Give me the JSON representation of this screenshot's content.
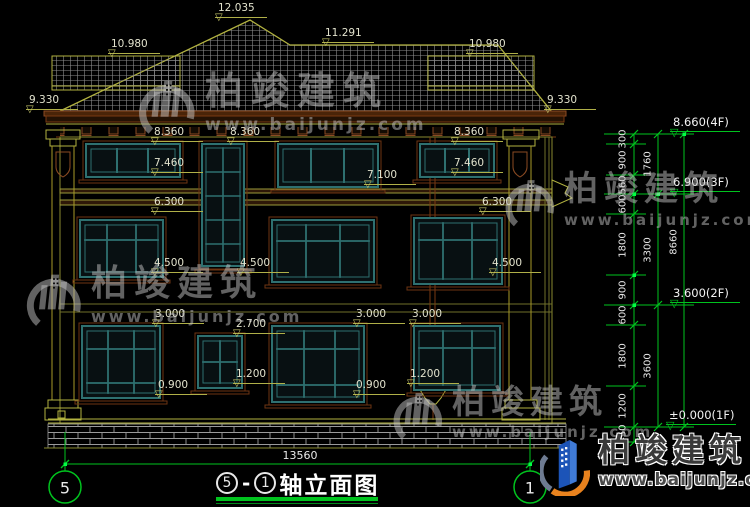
{
  "drawing_title": {
    "axis_a": "5",
    "sep": "-",
    "axis_b": "1",
    "name": "轴立面图"
  },
  "axis_bubbles": {
    "left": "5",
    "right": "1"
  },
  "overall_width": "13560",
  "watermark": {
    "brand": "柏竣建筑",
    "url": "www.baijunjz.com"
  },
  "footer_logo": {
    "brand": "柏竣建筑",
    "url": "www.baijunjz.com"
  },
  "colors": {
    "cad_green": "#00c31e",
    "cad_olive": "#b2b240",
    "window_teal": "#2e7070",
    "trim_brown": "#6e3512",
    "logo_blue": "#1c54b8",
    "logo_orange": "#e8821e"
  },
  "building_markers": [
    {
      "text": "12.035",
      "x": 215,
      "level": 20
    },
    {
      "text": "10.980",
      "x": 108,
      "level": 56
    },
    {
      "text": "11.291",
      "x": 322,
      "level": 45
    },
    {
      "text": "10.980",
      "x": 466,
      "level": 56
    },
    {
      "text": "9.330",
      "x": 26,
      "level": 112
    },
    {
      "text": "9.330",
      "x": 544,
      "level": 112
    },
    {
      "text": "8.360",
      "x": 151,
      "level": 144
    },
    {
      "text": "8.360",
      "x": 227,
      "level": 144
    },
    {
      "text": "8.360",
      "x": 451,
      "level": 144
    },
    {
      "text": "7.460",
      "x": 151,
      "level": 175
    },
    {
      "text": "7.460",
      "x": 451,
      "level": 175
    },
    {
      "text": "7.100",
      "x": 364,
      "level": 187
    },
    {
      "text": "6.300",
      "x": 151,
      "level": 214
    },
    {
      "text": "6.300",
      "x": 479,
      "level": 214
    },
    {
      "text": "4.500",
      "x": 151,
      "level": 275
    },
    {
      "text": "4.500",
      "x": 237,
      "level": 275
    },
    {
      "text": "4.500",
      "x": 489,
      "level": 275
    },
    {
      "text": "3.000",
      "x": 152,
      "level": 326
    },
    {
      "text": "3.000",
      "x": 353,
      "level": 326
    },
    {
      "text": "3.000",
      "x": 409,
      "level": 326
    },
    {
      "text": "2.700",
      "x": 233,
      "level": 336
    },
    {
      "text": "1.200",
      "x": 233,
      "level": 386
    },
    {
      "text": "1.200",
      "x": 407,
      "level": 386
    },
    {
      "text": "0.900",
      "x": 155,
      "level": 397
    },
    {
      "text": "0.900",
      "x": 353,
      "level": 397
    }
  ],
  "floor_markers": [
    {
      "text": "8.660(4F)",
      "x": 670,
      "level": 134
    },
    {
      "text": "6.900(3F)",
      "x": 670,
      "level": 194
    },
    {
      "text": "3.600(2F)",
      "x": 670,
      "level": 305
    },
    {
      "text": "±0.000(1F)",
      "x": 666,
      "level": 427
    }
  ],
  "vertical_dims": [
    {
      "text": "300",
      "x": 623,
      "y": 139
    },
    {
      "text": "900",
      "x": 623,
      "y": 160
    },
    {
      "text": "560",
      "x": 623,
      "y": 185
    },
    {
      "text": "600",
      "x": 623,
      "y": 204
    },
    {
      "text": "1800",
      "x": 623,
      "y": 245
    },
    {
      "text": "900",
      "x": 623,
      "y": 290
    },
    {
      "text": "600",
      "x": 623,
      "y": 315
    },
    {
      "text": "1800",
      "x": 623,
      "y": 356
    },
    {
      "text": "1200",
      "x": 623,
      "y": 406
    },
    {
      "text": "450",
      "x": 623,
      "y": 434
    },
    {
      "text": "1760",
      "x": 648,
      "y": 164
    },
    {
      "text": "3300",
      "x": 648,
      "y": 250
    },
    {
      "text": "3600",
      "x": 648,
      "y": 366
    },
    {
      "text": "8660",
      "x": 674,
      "y": 242
    }
  ]
}
